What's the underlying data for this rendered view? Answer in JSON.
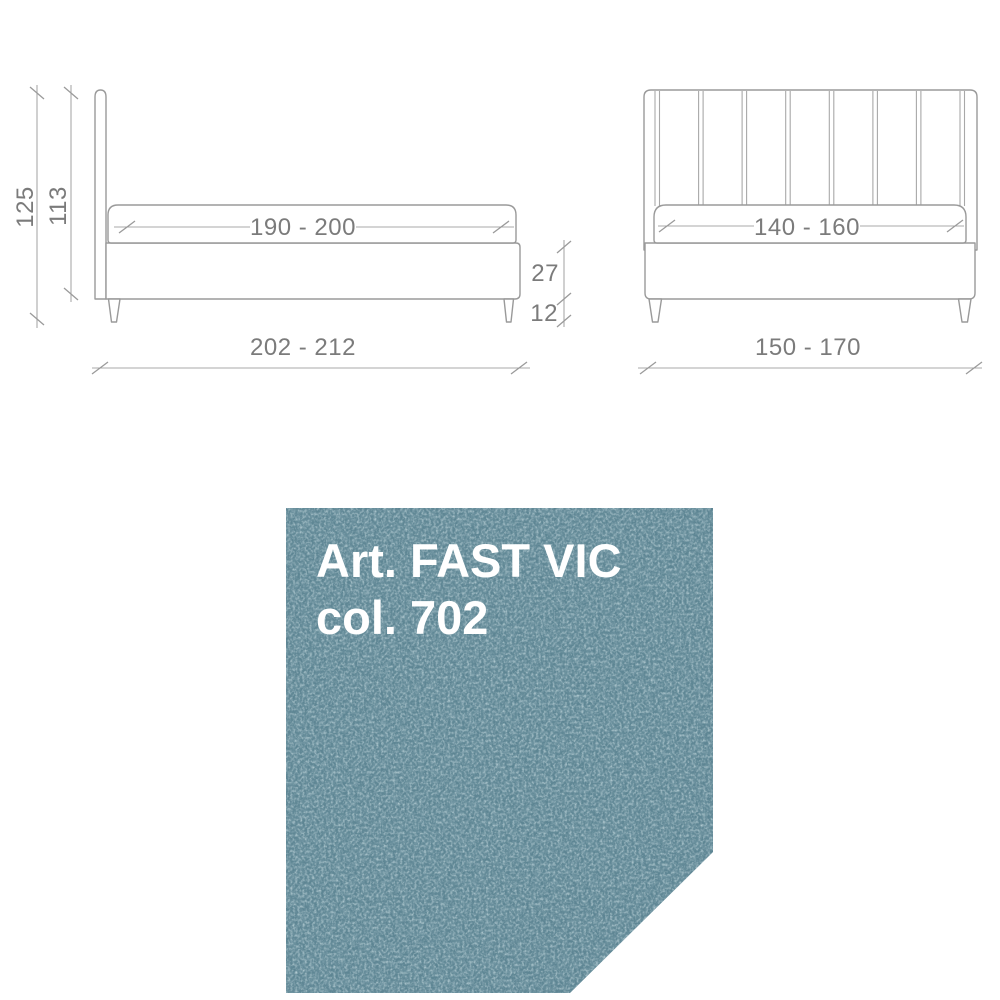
{
  "drawings": {
    "side_view": {
      "title": "bed side elevation",
      "dims": {
        "total_height": "125",
        "headboard_height": "113",
        "mattress_length": "190 - 200",
        "total_length": "202 - 212",
        "frame_height": "27",
        "leg_height": "12"
      }
    },
    "front_view": {
      "title": "bed front elevation",
      "dims": {
        "mattress_width": "140 - 160",
        "total_width": "150 - 170"
      }
    },
    "outline_color": "#9a9a9a",
    "dimension_text_color": "#7b7b7b"
  },
  "swatch": {
    "line1": "Art. FAST VIC",
    "line2": "col. 702",
    "text_color": "#ffffff",
    "fabric_base_color": "#5d8593",
    "fabric_light_color": "#96b9c2",
    "fabric_dark_color": "#36596a"
  }
}
